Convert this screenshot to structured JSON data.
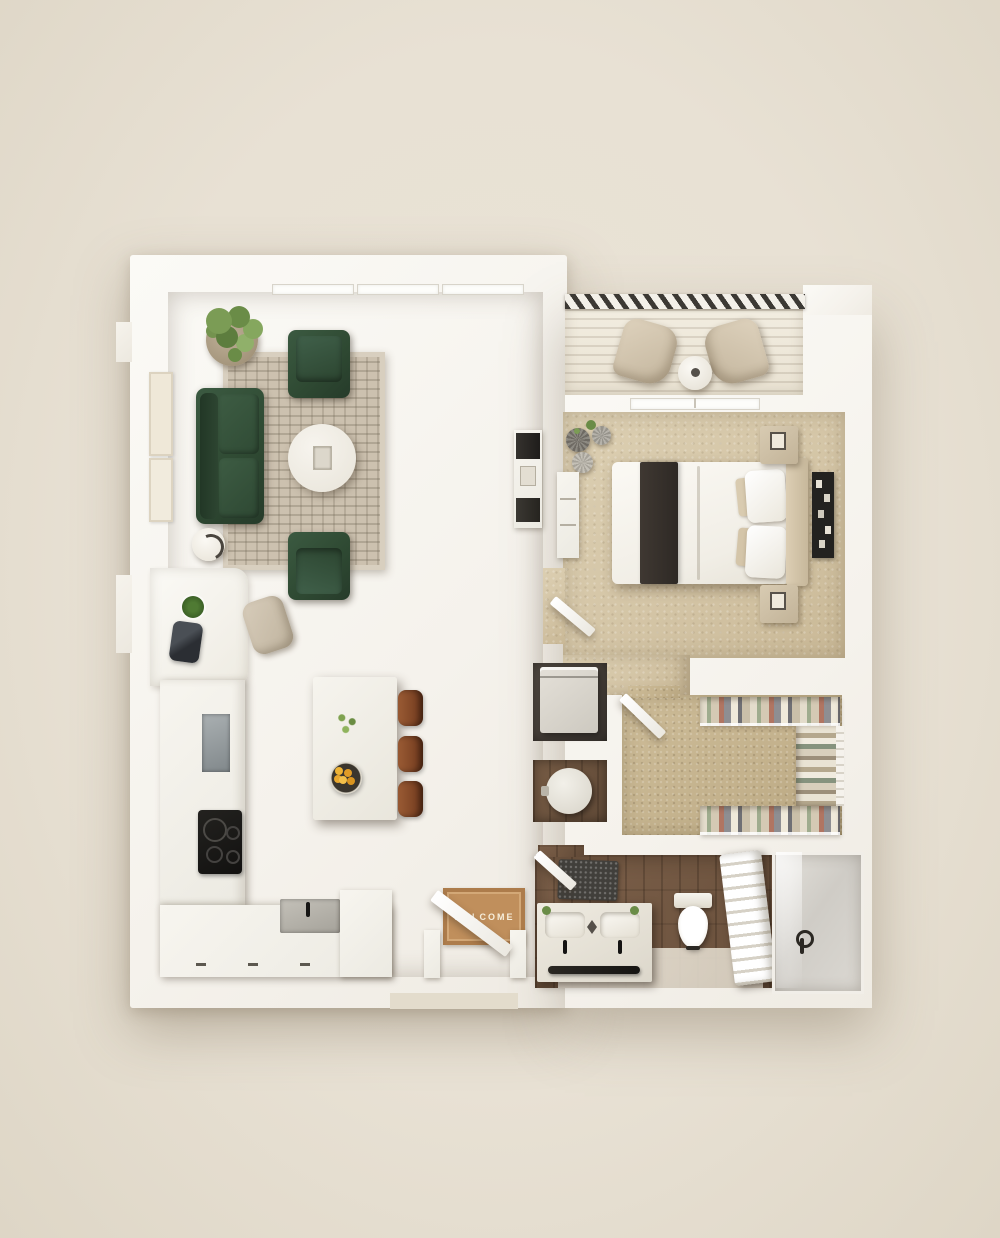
{
  "scene": {
    "description": "3D rendered top-down floor plan of a one-bedroom apartment on a beige background",
    "view": "top-down"
  },
  "labels": {
    "welcome_mat": "WELCOME"
  },
  "palette": {
    "background": "#e8e1d4",
    "wall_white": "#f7f4ee",
    "wood_floor": "#b29a7e",
    "bedroom_carpet": "#d5c6a8",
    "closet_carpet": "#c6b48e",
    "bathroom_floor": "#6f5540",
    "balcony_deck": "#efe9dc",
    "sofa_green": "#2f4a33",
    "rug_greige": "#ccc1af",
    "stool_brown": "#7d4527",
    "mat_tan": "#c08f5c",
    "cooktop_black": "#1b1a18",
    "fruit_orange": "#e8a72e"
  },
  "rooms": [
    {
      "id": "living-room",
      "furniture": [
        "green-sofa",
        "green-armchair",
        "green-armchair",
        "round-coffee-table",
        "area-rug",
        "potted-plant",
        "side-table-lamp",
        "media-console",
        "wall-frames",
        "windows"
      ]
    },
    {
      "id": "dining-kitchen",
      "furniture": [
        "kitchen-island",
        "bar-stool",
        "bar-stool",
        "bar-stool",
        "fruit-bowl",
        "l-shaped-cabinets",
        "cooktop",
        "oven-panel",
        "sink"
      ]
    },
    {
      "id": "desk-nook",
      "furniture": [
        "desk",
        "laptop",
        "desk-plant",
        "desk-chair"
      ]
    },
    {
      "id": "balcony",
      "furniture": [
        "lounge-chair",
        "lounge-chair",
        "round-side-table",
        "railing"
      ]
    },
    {
      "id": "bedroom",
      "furniture": [
        "double-bed",
        "dark-bed-runner",
        "pillows",
        "headboard",
        "nightstand",
        "nightstand",
        "wall-art",
        "dresser",
        "planters",
        "sliding-balcony-door"
      ]
    },
    {
      "id": "walk-in-closet",
      "furniture": [
        "clothes-rack-top",
        "clothes-rack-right",
        "clothes-rack-bottom",
        "shelf-unit",
        "door"
      ]
    },
    {
      "id": "bathroom",
      "furniture": [
        "double-vanity",
        "black-faucets",
        "towel-bar",
        "bath-mat",
        "toilet",
        "towel-shelf",
        "glass-shower",
        "door"
      ]
    },
    {
      "id": "utility-closets",
      "furniture": [
        "washer-box",
        "water-heater-tank"
      ]
    },
    {
      "id": "entry",
      "furniture": [
        "entry-door",
        "welcome-mat",
        "door-frame"
      ]
    }
  ]
}
